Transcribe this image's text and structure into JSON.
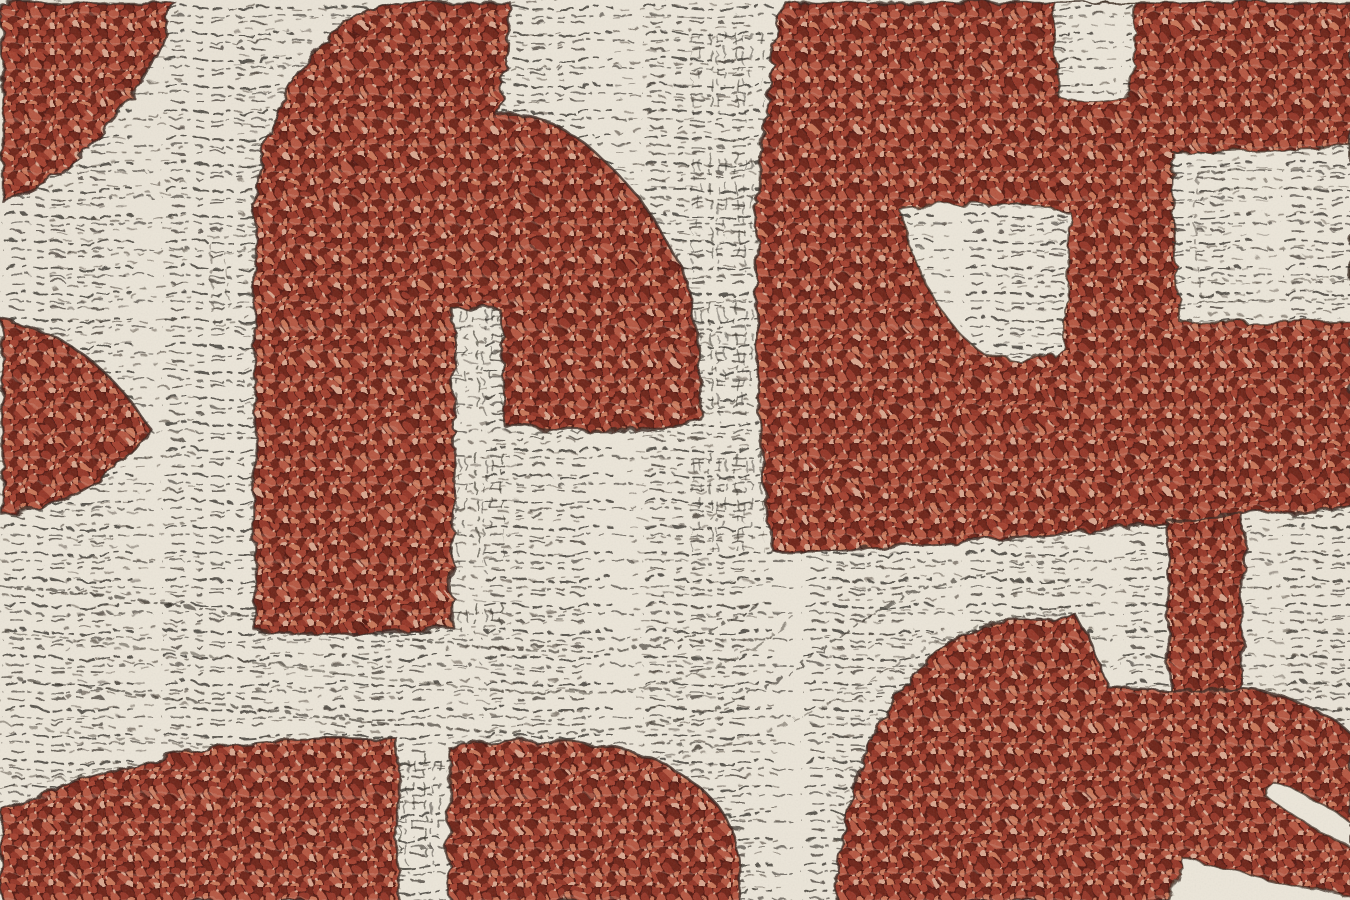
{
  "image": {
    "kind": "macro photograph of woven fabric",
    "aria_label": "Close-up of a jacquard boucle upholstery fabric: abstract rust-red interlocking shapes on a cream ground covered with dark scribbled stitch lines",
    "motifs": [
      "top-left red corner blob",
      "tall red arch with white slot",
      "left-edge red arrowhead",
      "top-right red mass with white square notch",
      "white rectangular inset at right edge",
      "white tongue inset",
      "white sweeping band with curved stitch lines",
      "red connecting stub",
      "bottom-left red blob with white vertical strip",
      "bottom-center red blob",
      "bottom-right red mass"
    ]
  },
  "palette": {
    "cream_base": "#ece6d9",
    "cream_bright": "#f6f1e8",
    "cream_shade": "#d9d0c1",
    "scribble_dark": "#2e2821",
    "scribble_soft": "#544a3f",
    "outline_dark": "#38261e",
    "red_shadow": "#521811",
    "red_deep": "#6d2118",
    "red_base": "#943526",
    "red_mid": "#a4412f",
    "red_bright": "#b55640",
    "red_light": "#c87457",
    "pink_highlight": "#d9a68e"
  }
}
